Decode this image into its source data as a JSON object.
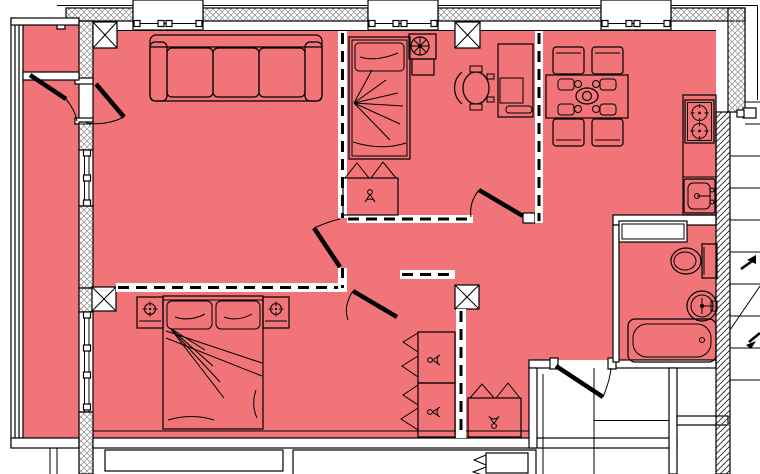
{
  "colors": {
    "room_fill": "#f07478",
    "wall_line": "#000000",
    "hatch_line": "#9b9b9b",
    "diag_hatch_line": "#3c3c3c",
    "background": "#ffffff",
    "door_leaf": "#000000"
  },
  "elements": {
    "rooms": [
      "balcony",
      "living-room",
      "study-bedroom",
      "kitchen-dining-room",
      "master-bedroom",
      "hallway",
      "bathroom",
      "entrance-vestibule",
      "stairwell",
      "neighbor-rooms"
    ],
    "furniture": [
      "sofa",
      "single-bed",
      "double-bed",
      "nightstand-left",
      "nightstand-right",
      "plant-stand",
      "desk",
      "office-chair",
      "dining-table",
      "dining-chairs",
      "wardrobe-study",
      "wardrobe-bedroom-upper",
      "wardrobe-bedroom-lower",
      "wardrobe-hallway",
      "wardrobe-neighbor"
    ],
    "fixtures": [
      "stove-two-burners",
      "kitchen-sink",
      "toilet",
      "round-wash-basin",
      "bathtub",
      "built-in-cabinet"
    ],
    "symbols": [
      "structural-column-x",
      "window-with-mullions",
      "door-swing-arc",
      "dashed-partition",
      "crosshatch-exterior-wall",
      "diagonal-hatch-wall",
      "stair-treads",
      "stair-direction-arrow",
      "table-lamp",
      "hanger-glyph",
      "potted-plant"
    ]
  }
}
